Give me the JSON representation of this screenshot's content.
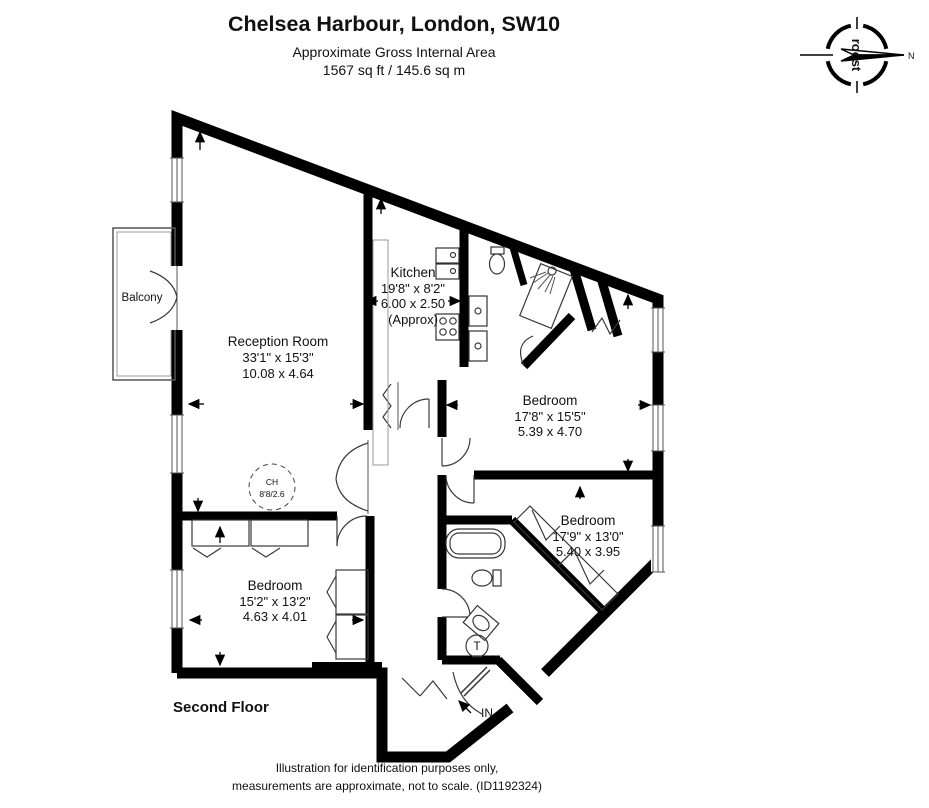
{
  "header": {
    "title": "Chelsea Harbour, London, SW10",
    "subtitle": "Approximate Gross Internal Area",
    "area": "1567  sq ft / 145.6 sq m"
  },
  "compass": {
    "brand": "roost",
    "north": "N"
  },
  "rooms": {
    "reception": {
      "name": "Reception Room",
      "imperial": "33'1\" x 15'3\"",
      "metric": "10.08 x 4.64"
    },
    "kitchen": {
      "name": "Kitchen",
      "imperial": "19'8\" x 8'2\"",
      "metric": "6.00 x 2.50",
      "approx": "(Approx)"
    },
    "bedroom_top": {
      "name": "Bedroom",
      "imperial": "17'8\" x 15'5\"",
      "metric": "5.39 x 4.70"
    },
    "bedroom_middle": {
      "name": "Bedroom",
      "imperial": "17'9\" x 13'0\"",
      "metric": "5.40 x 3.95"
    },
    "bedroom_left": {
      "name": "Bedroom",
      "imperial": "15'2\" x 13'2\"",
      "metric": "4.63 x 4.01"
    },
    "balcony": {
      "name": "Balcony"
    }
  },
  "annotations": {
    "ceiling_height_label": "CH",
    "ceiling_height_value": "8'8/2.6",
    "entrance": "IN",
    "tank": "T",
    "floor": "Second Floor"
  },
  "footer": {
    "line1": "Illustration for identification purposes only,",
    "line2": "measurements are approximate, not to scale. (ID1192324)"
  }
}
